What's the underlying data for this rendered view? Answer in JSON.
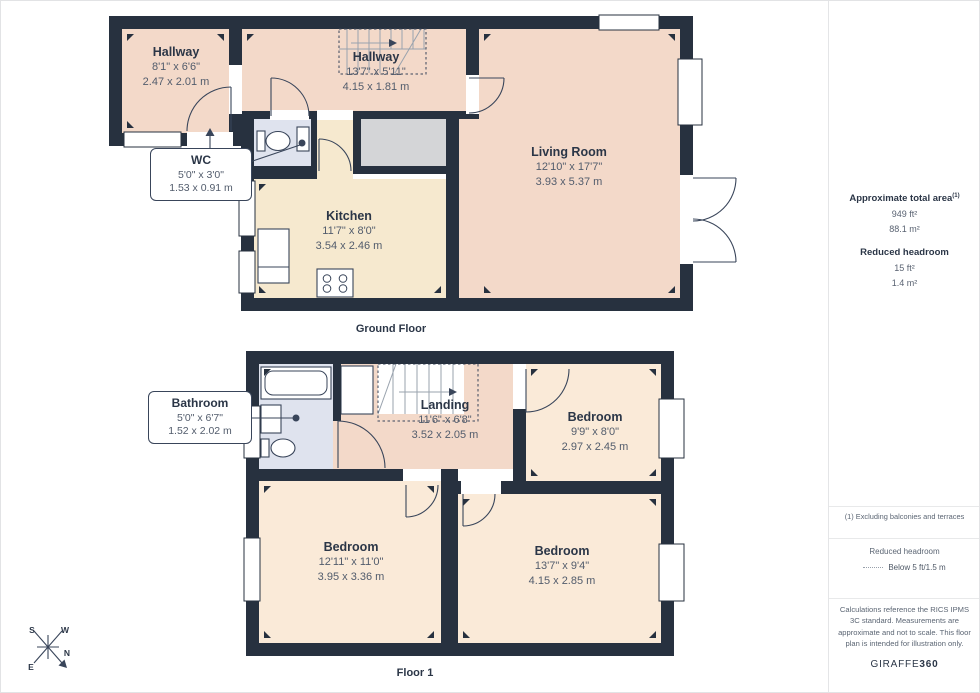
{
  "floors": [
    {
      "title": "Ground Floor",
      "rooms": [
        {
          "name": "Hallway",
          "imperial": "8'1\" x 6'6\"",
          "metric": "2.47 x 2.01 m"
        },
        {
          "name": "Hallway",
          "imperial": "13'7\" x 5'11\"",
          "metric": "4.15 x 1.81 m"
        },
        {
          "name": "WC",
          "imperial": "5'0\" x 3'0\"",
          "metric": "1.53 x 0.91 m"
        },
        {
          "name": "Kitchen",
          "imperial": "11'7\" x 8'0\"",
          "metric": "3.54 x 2.46 m"
        },
        {
          "name": "Living Room",
          "imperial": "12'10\" x 17'7\"",
          "metric": "3.93 x 5.37 m"
        }
      ]
    },
    {
      "title": "Floor 1",
      "rooms": [
        {
          "name": "Bathroom",
          "imperial": "5'0\" x 6'7\"",
          "metric": "1.52 x 2.02 m"
        },
        {
          "name": "Landing",
          "imperial": "11'6\" x 6'8\"",
          "metric": "3.52 x 2.05 m"
        },
        {
          "name": "Bedroom",
          "imperial": "9'9\" x 8'0\"",
          "metric": "2.97 x 2.45 m"
        },
        {
          "name": "Bedroom",
          "imperial": "12'11\" x 11'0\"",
          "metric": "3.95 x 3.36 m"
        },
        {
          "name": "Bedroom",
          "imperial": "13'7\" x 9'4\"",
          "metric": "4.15 x 2.85 m"
        }
      ]
    }
  ],
  "compass": {
    "n": "N",
    "s": "S",
    "e": "E",
    "w": "W"
  },
  "sidebar": {
    "total_area": {
      "heading": "Approximate total area",
      "superscript": "(1)",
      "value_ft": "949 ft²",
      "value_m": "88.1 m²"
    },
    "reduced_headroom": {
      "heading": "Reduced headroom",
      "value_ft": "15 ft²",
      "value_m": "1.4 m²"
    },
    "footnote": "(1) Excluding balconies and terraces",
    "legend": {
      "heading": "Reduced headroom",
      "label": "Below 5 ft/1.5 m"
    },
    "disclaimer": "Calculations reference the RICS IPMS 3C standard. Measurements are approximate and not to scale. This floor plan is intended for illustration only.",
    "brand": {
      "name": "GIRAFFE",
      "suffix": "360"
    }
  },
  "colors": {
    "wall": "#27313f",
    "room_pink": "#f3d9c9",
    "room_cream": "#f6e9cf",
    "room_cream_light": "#faead8",
    "room_blue": "#dfe3ee",
    "room_grey": "#d4d5d7",
    "line": "#39455a",
    "stair_line": "#9aa3ae"
  }
}
